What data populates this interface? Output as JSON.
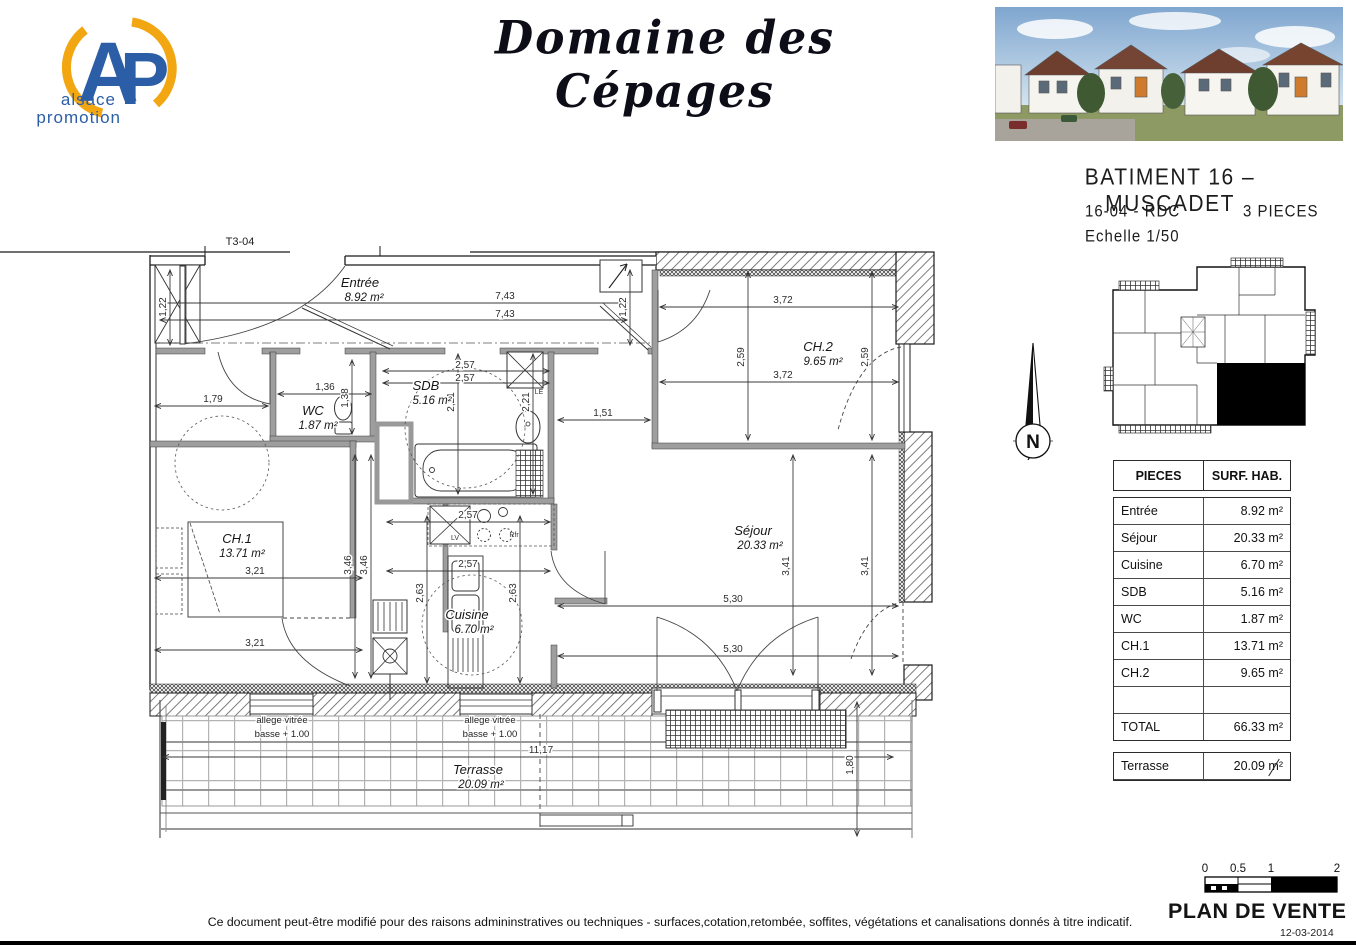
{
  "colors": {
    "logo_blue": "#2b5ea7",
    "logo_yellow": "#f2a712",
    "wall_black": "#1a1a1a"
  },
  "header": {
    "logo": {
      "acronym_a": "A",
      "acronym_p": "P",
      "line1": "alsace",
      "line2": "promotion"
    },
    "title": "Domaine des Cépages",
    "building": "BATIMENT 16 – MUSCADET",
    "unit": "16-04 - RDC",
    "rooms_count": "3 PIECES",
    "scale": "Echelle 1/50"
  },
  "plan": {
    "ref": "T3-04",
    "north": "N",
    "rooms": {
      "entree": {
        "name": "Entrée",
        "area": "8.92 m²"
      },
      "sejour": {
        "name": "Séjour",
        "area": "20.33 m²"
      },
      "cuisine": {
        "name": "Cuisine",
        "area": "6.70 m²"
      },
      "sdb": {
        "name": "SDB",
        "area": "5.16 m²"
      },
      "wc": {
        "name": "WC",
        "area": "1.87 m²"
      },
      "ch1": {
        "name": "CH.1",
        "area": "13.71 m²"
      },
      "ch2": {
        "name": "CH.2",
        "area": "9.65 m²"
      },
      "terrasse": {
        "name": "Terrasse",
        "area": "20.09 m²"
      }
    },
    "dims": {
      "v743": "7,43",
      "v122": "1,22",
      "v136": "1,36",
      "v257": "2,57",
      "v372": "3,72",
      "v179": "1,79",
      "v151": "1,51",
      "v259": "2,59",
      "v221": "2,21",
      "v138": "1,38",
      "v321": "3,21",
      "v346": "3,46",
      "v263": "2,63",
      "v530": "5,30",
      "v341": "3,41",
      "v1117": "11,17",
      "v180": "1,80"
    },
    "notes": {
      "allege1": "allege vitrée",
      "allege2": "basse + 1.00",
      "lv": "LV",
      "rfr": "Rfr",
      "le": "LE"
    }
  },
  "table": {
    "headers": [
      "PIECES",
      "SURF. HAB."
    ],
    "rows": [
      {
        "name": "Entrée",
        "area": "8.92 m²"
      },
      {
        "name": "Séjour",
        "area": "20.33 m²"
      },
      {
        "name": "Cuisine",
        "area": "6.70 m²"
      },
      {
        "name": "SDB",
        "area": "5.16 m²"
      },
      {
        "name": "WC",
        "area": "1.87 m²"
      },
      {
        "name": "CH.1",
        "area": "13.71 m²"
      },
      {
        "name": "CH.2",
        "area": "9.65 m²"
      },
      {
        "name": "",
        "area": ""
      },
      {
        "name": "TOTAL",
        "area": "66.33 m²"
      }
    ],
    "terrace": {
      "name": "Terrasse",
      "area": "20.09 m²"
    }
  },
  "footer": {
    "scalebar": [
      "0",
      "0.5",
      "1",
      "2"
    ],
    "plan_type": "PLAN DE VENTE",
    "date": "12-03-2014",
    "disclaimer": "Ce document peut-être modifié pour des raisons admininstratives ou techniques - surfaces,cotation,retombée, soffites, végétations et canalisations donnés à titre indicatif."
  }
}
